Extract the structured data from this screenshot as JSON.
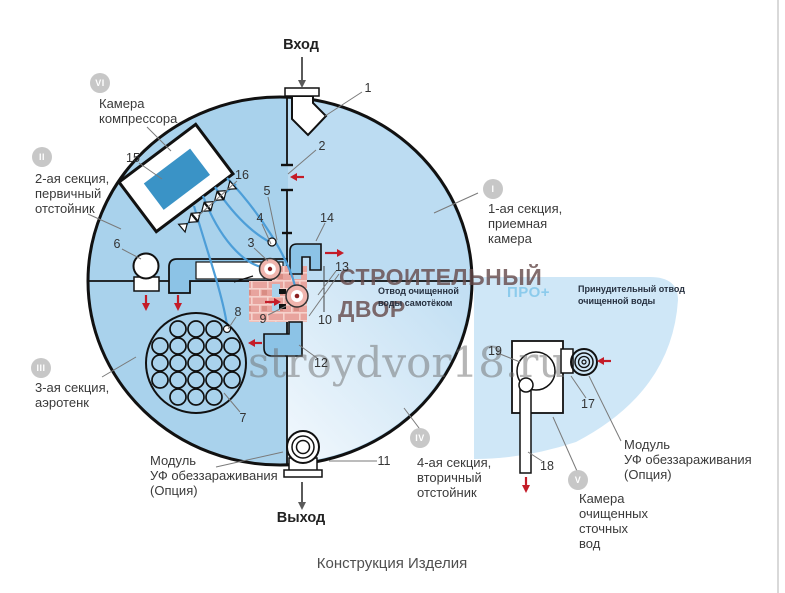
{
  "title": "Конструкция Изделия",
  "flow": {
    "inlet_label": "Вход",
    "outlet_label": "Выход"
  },
  "watermark": {
    "brand_line1": "СТРОИТЕЛЬНЫЙ",
    "brand_line2": "ДВОР",
    "site": "stroydvor18.ru"
  },
  "annotations": {
    "gravity_outlet": "Отвод очищенной\nводы самотёком",
    "pro_plus": "ПРО+",
    "forced_outlet": "Принудительный отвод\nочищенной воды"
  },
  "sections": [
    {
      "numeral": "I",
      "label": "1-ая секция,\nприемная\nкамера"
    },
    {
      "numeral": "II",
      "label": "2-ая секция,\nпервичный\nотстойник"
    },
    {
      "numeral": "III",
      "label": "3-ая секция,\nаэротенк"
    },
    {
      "numeral": "IV",
      "label": "4-ая секция,\nвторичный\nотстойник"
    },
    {
      "numeral": "V",
      "label": "Камера\nочищенных\nсточных\nвод"
    },
    {
      "numeral": "VI",
      "label": "Камера\nкомпрессора"
    }
  ],
  "modules": {
    "uv_left": "Модуль\nУФ обеззараживания\n(Опция)",
    "uv_right": "Модуль\nУФ обеззараживания\n(Опция)"
  },
  "part_numbers": {
    "n1": "1",
    "n2": "2",
    "n3": "3",
    "n4": "4",
    "n5": "5",
    "n6": "6",
    "n7": "7",
    "n8": "8",
    "n9": "9",
    "n10": "10",
    "n11": "11",
    "n12": "12",
    "n13": "13",
    "n14": "14",
    "n15": "15",
    "n16": "16",
    "n17": "17",
    "n18": "18",
    "n19": "19"
  },
  "colors": {
    "tank_left": "#a9d2ec",
    "tank_right_top": "#bcdcf2",
    "tank_right_bottom_light": "#ecf5fc",
    "pipe_blue": "#8cc3e6",
    "compressor_blue": "#3a93c6",
    "air_tube_blue": "#4d9ed8",
    "brick_pink": "#e8a49e",
    "arrow_red": "#c41c28",
    "badge_gray": "#c7c7c7",
    "pro_blue": "#8ccbec",
    "quarter_disc": "#cfe7f7"
  }
}
